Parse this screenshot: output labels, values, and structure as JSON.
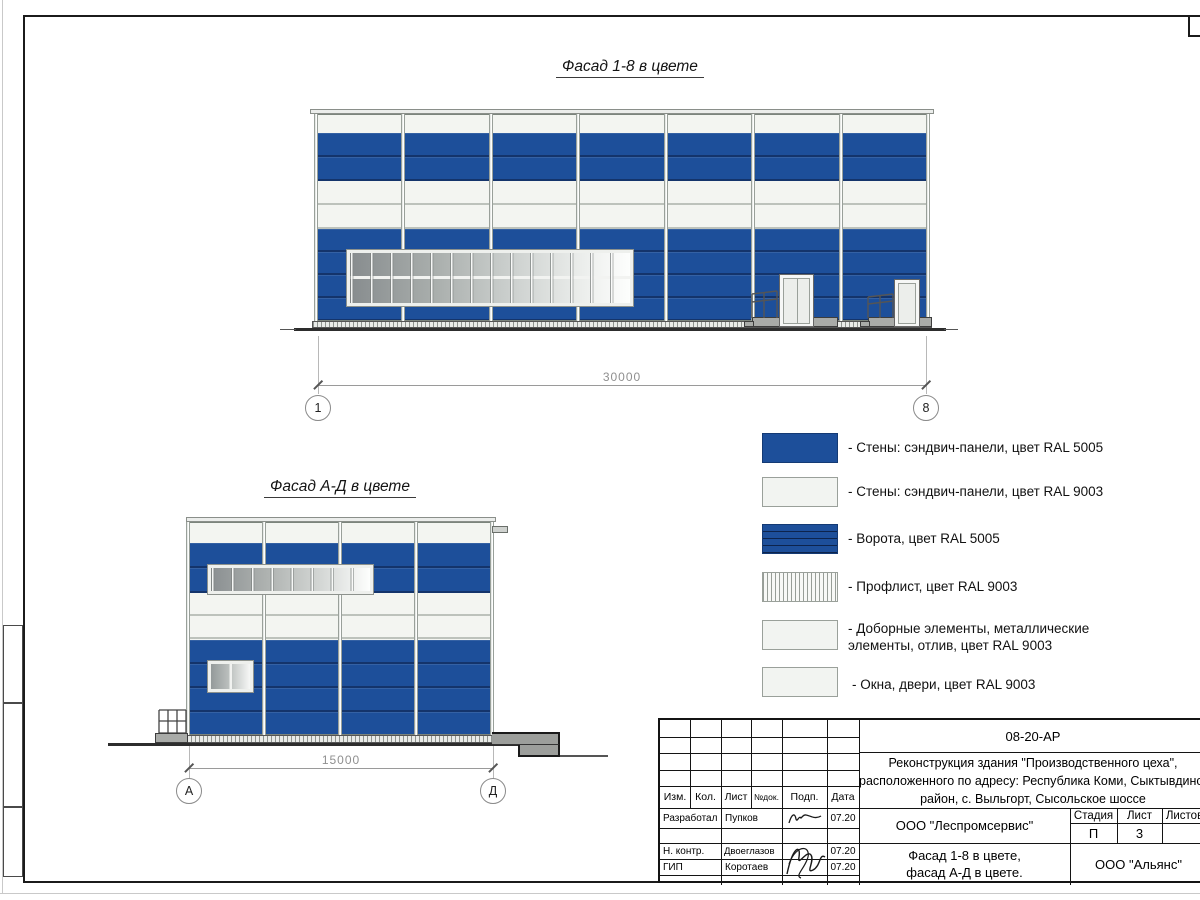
{
  "sheet": {
    "facade_top_title": "Фасад 1-8 в цвете",
    "facade_bottom_title": "Фасад А-Д в цвете",
    "dim_top": "30000",
    "dim_bottom": "15000",
    "axis_top_left": "1",
    "axis_top_right": "8",
    "axis_bottom_left": "А",
    "axis_bottom_right": "Д"
  },
  "colors": {
    "ral5005_blue": "#1d4f9a",
    "ral9003_white": "#f3f5f1"
  },
  "legend": {
    "items": [
      {
        "swatch": "solid-blue",
        "label": "- Стены: сэндвич-панели, цвет RAL 5005"
      },
      {
        "swatch": "solid-white",
        "label": "- Стены: сэндвич-панели, цвет RAL 9003"
      },
      {
        "swatch": "gate-blue",
        "label": "- Ворота, цвет RAL 5005"
      },
      {
        "swatch": "hatch-white",
        "label": "- Профлист, цвет RAL 9003"
      },
      {
        "swatch": "solid-white",
        "label": "- Доборные элементы, металлические элементы, отлив, цвет RAL 9003"
      },
      {
        "swatch": "solid-white",
        "label": "- Окна, двери, цвет RAL 9003"
      }
    ]
  },
  "title_block": {
    "doc_code": "08-20-АР",
    "project_lines": [
      "Реконструкция здания \"Производственного цеха\",",
      "расположенного по адресу: Республика Коми, Сыктывдинский",
      "район, с. Выльгорт, Сысольское шоссе"
    ],
    "columns": {
      "izm": "Изм.",
      "kol": "Кол.",
      "list": "Лист",
      "ndok": "№док.",
      "podp": "Подп.",
      "data": "Дата"
    },
    "rows": [
      {
        "role": "Разработал",
        "name": "Пупков",
        "date": "07.20"
      },
      {
        "role": "Н. контр.",
        "name": "Двоеглазов",
        "date": "07.20"
      },
      {
        "role": "ГИП",
        "name": "Коротаев",
        "date": "07.20"
      }
    ],
    "org_middle": "ООО \"Леспромсервис\"",
    "sheet_title_lines": [
      "Фасад 1-8 в цвете,",
      "фасад А-Д в цвете."
    ],
    "stage_headers": {
      "stage": "Стадия",
      "list": "Лист",
      "listov": "Листов"
    },
    "stage_value": "П",
    "list_value": "3",
    "org_right": "ООО \"Альянс\""
  }
}
